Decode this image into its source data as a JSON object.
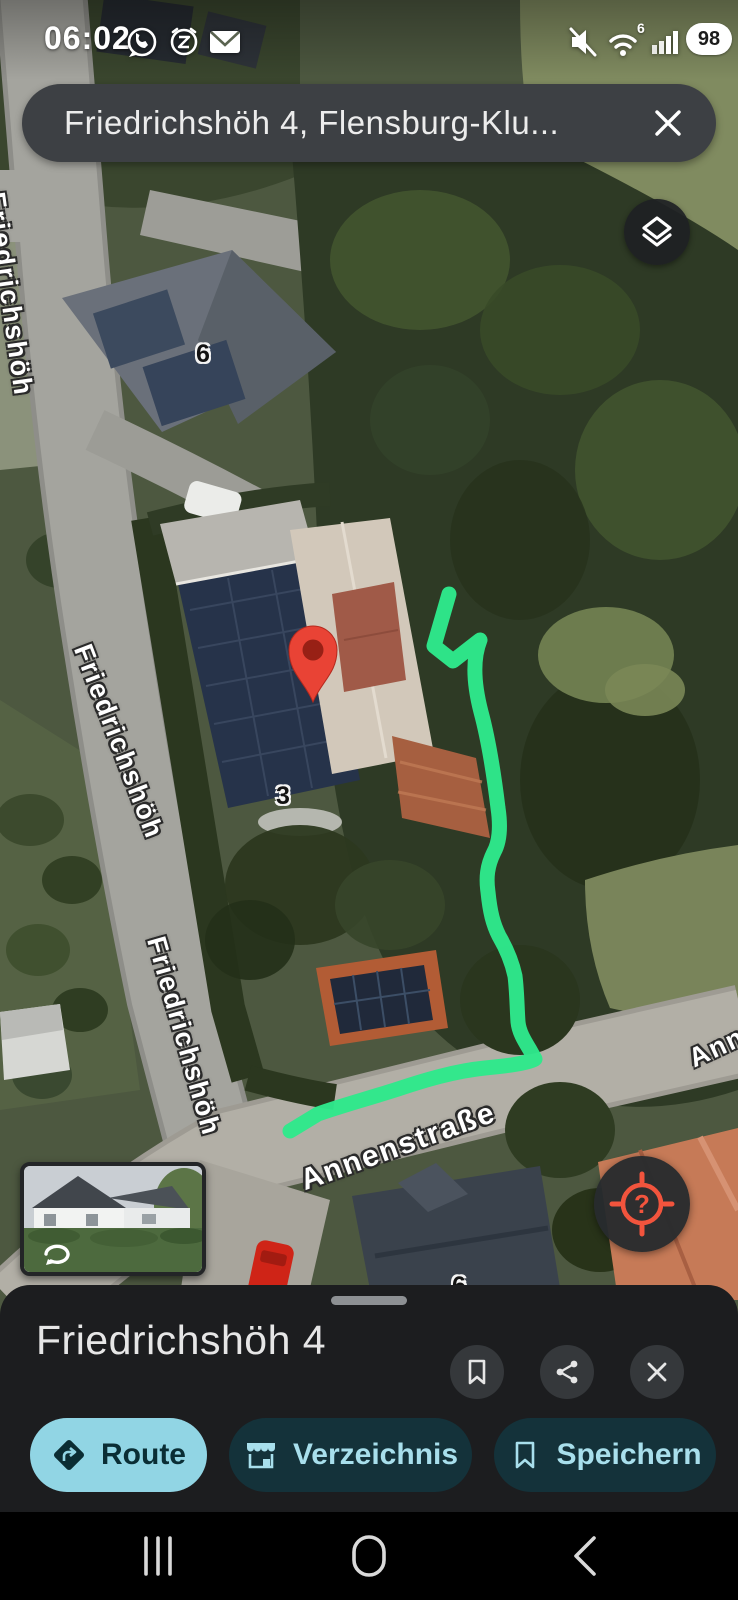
{
  "status_bar": {
    "time": "06:02",
    "wifi_label": "6",
    "battery_percent": "98"
  },
  "search": {
    "query": "Friedrichshöh 4, Flensburg-Klu..."
  },
  "map": {
    "street_labels": [
      "Friedrichshöh",
      "Friedrichshöh",
      "Friedrichshöh",
      "Annenstraße",
      "Ann"
    ],
    "house_numbers": [
      "6",
      "3",
      "6"
    ],
    "locate_hint": "?"
  },
  "bottom_sheet": {
    "title": "Friedrichshöh 4",
    "actions": {
      "route": "Route",
      "directory": "Verzeichnis",
      "save": "Speichern"
    }
  },
  "colors": {
    "route_line": "#2EE88B",
    "pin": "#E94335",
    "primary_action_bg": "#91D5E4",
    "secondary_action_bg": "#14323A",
    "secondary_action_text": "#A8DFEC",
    "locate_icon": "#F2543D"
  }
}
